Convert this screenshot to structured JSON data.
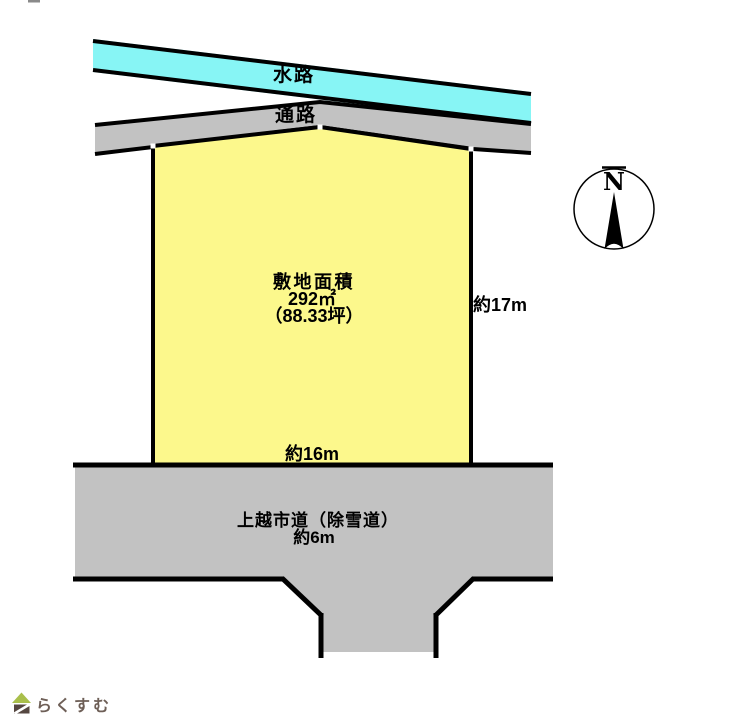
{
  "diagram": {
    "waterway": {
      "label": "水路"
    },
    "passage": {
      "label": "通路"
    },
    "plot": {
      "title": "敷地面積",
      "area_sqm": "292㎡",
      "area_tsubo": "（88.33坪）",
      "frontage_label": "約16m",
      "depth_label": "約17m"
    },
    "road": {
      "name": "上越市道（除雪道）",
      "width_label": "約6m"
    },
    "compass": {
      "north_label": "N"
    },
    "colors": {
      "waterway_fill": "#87F5F5",
      "passage_fill": "#C2C2C2",
      "plot_fill": "#FCF88C",
      "road_fill": "#C2C2C2",
      "outline": "#000000",
      "vertex_marker": "#FFFFFF",
      "logo_roof_green": "#A9BF4B",
      "logo_body_brown": "#554741",
      "logo_text_color": "#6E5F57"
    }
  },
  "footer": {
    "logo_text": "らくすむ"
  }
}
